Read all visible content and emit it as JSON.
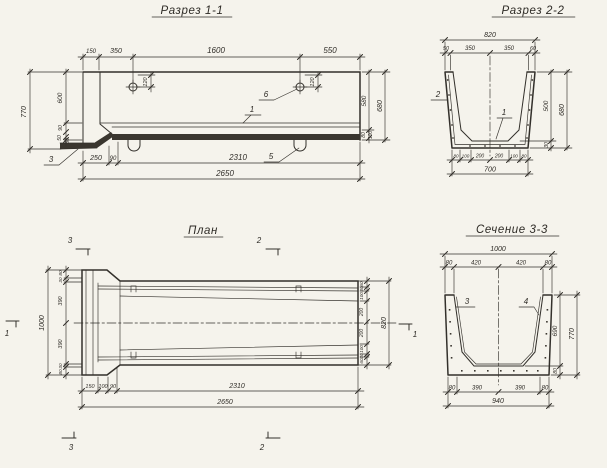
{
  "sheet": {
    "background": "#f5f3ec",
    "ink": "#33302b"
  },
  "views": {
    "razrez11": {
      "title": "Разрез 1-1",
      "top_dims": [
        "150",
        "350",
        "1600",
        "550"
      ],
      "hole_dim": "120",
      "left_overall": "770",
      "left_dims": [
        "600",
        "90",
        "50",
        "30"
      ],
      "right_dims": [
        "580",
        "680",
        "80",
        "100"
      ],
      "bottom_dims": [
        "250",
        "90",
        "2310"
      ],
      "bottom_overall": "2650",
      "callouts": {
        "c1": "1",
        "c3": "3",
        "c5": "5",
        "c6": "6"
      }
    },
    "razrez22": {
      "title": "Разрез 2-2",
      "top_overall": "820",
      "top_dims": [
        "50",
        "350",
        "350",
        "60"
      ],
      "right_dims": [
        "500",
        "30",
        "680"
      ],
      "bottom_dims": [
        "80",
        "100",
        "200",
        "200",
        "100",
        "80"
      ],
      "bottom_overall": "700",
      "callouts": {
        "c1": "1",
        "c2": "2"
      }
    },
    "plan": {
      "title": "План",
      "left_overall": "1000",
      "left_dims": [
        "80",
        "30",
        "390",
        "390",
        "30",
        "80"
      ],
      "right_dims": [
        "60",
        "30",
        "100",
        "200",
        "200",
        "100",
        "30",
        "60"
      ],
      "right_overall": "820",
      "bottom_dims": [
        "150",
        "100",
        "90",
        "2310"
      ],
      "bottom_overall": "2650",
      "markers": {
        "m1": "1",
        "m2": "2",
        "m3": "3"
      }
    },
    "sechenie33": {
      "title": "Сечение 3-3",
      "top_overall": "1000",
      "top_dims": [
        "80",
        "420",
        "420",
        "80"
      ],
      "right_dims": [
        "690",
        "80",
        "770"
      ],
      "bottom_dims": [
        "80",
        "390",
        "390",
        "80"
      ],
      "bottom_overall": "940",
      "callouts": {
        "c3": "3",
        "c4": "4"
      }
    }
  }
}
